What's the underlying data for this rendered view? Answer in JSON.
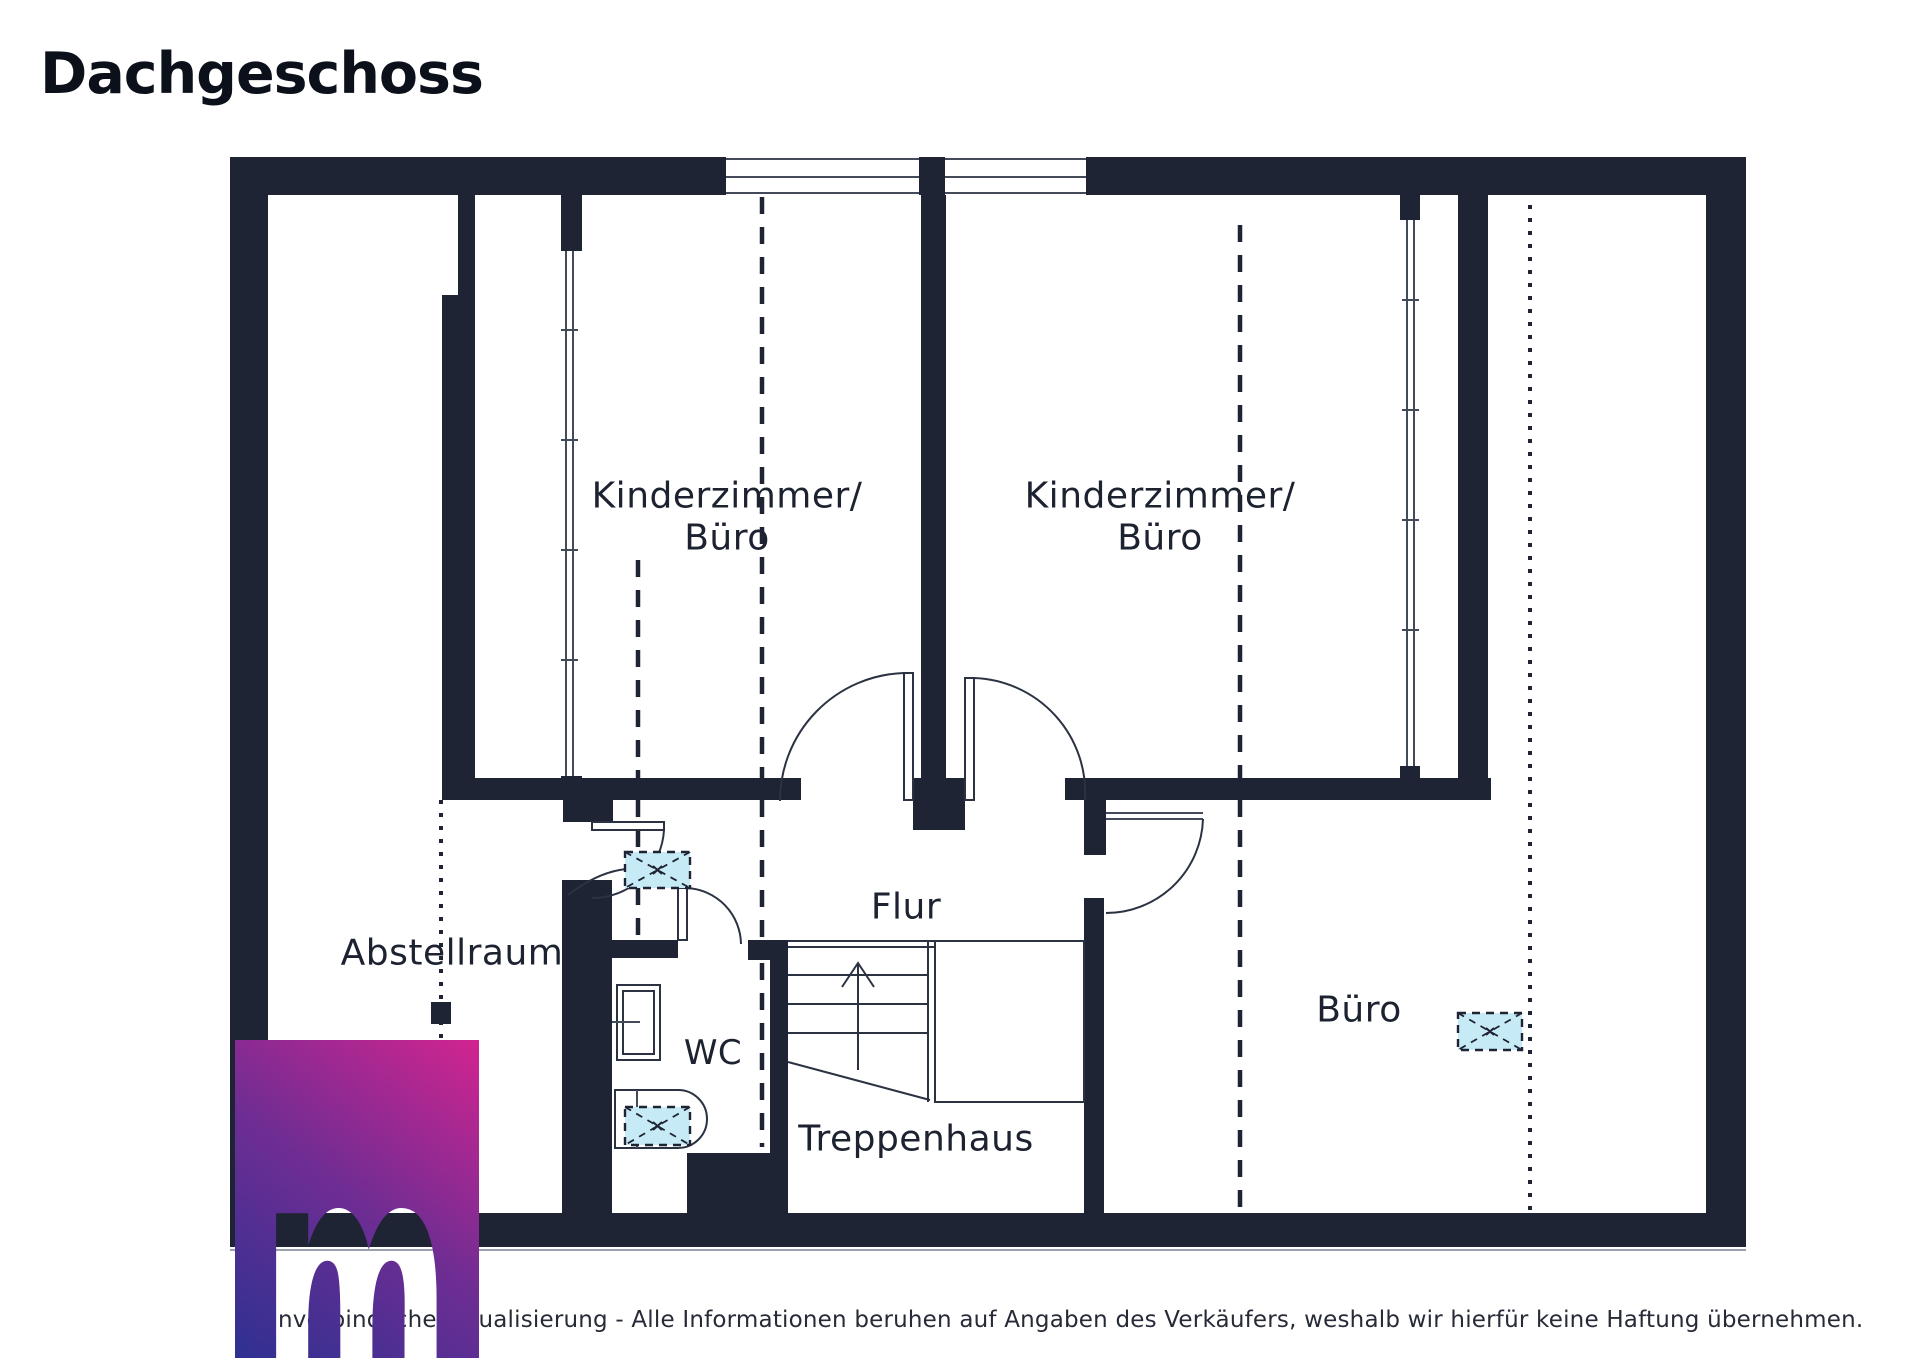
{
  "title": "Dachgeschoss",
  "rooms": {
    "k1": {
      "line1": "Kinderzimmer/",
      "line2": "Büro"
    },
    "k2": {
      "line1": "Kinderzimmer/",
      "line2": "Büro"
    },
    "flur": {
      "label": "Flur"
    },
    "abstellraum": {
      "label": "Abstellraum"
    },
    "wc": {
      "label": "WC"
    },
    "buero": {
      "label": "Büro"
    },
    "treppenhaus": {
      "label": "Treppenhaus"
    }
  },
  "footer": {
    "disclaimer": "Unverbindliche Visualisierung - Alle Informationen beruhen auf Angaben des Verkäufers, weshalb wir hierfür keine Haftung übernehmen."
  },
  "logo": {
    "letter": "m"
  },
  "symbols": {
    "skylight": "roof-window",
    "stairs_arrow": "up"
  },
  "colors": {
    "wall": "#1e2433",
    "label": "#1c2230",
    "skylight_fill": "#c7ebf6",
    "logo_blue": "#2e3192",
    "logo_purple": "#6f2d93",
    "logo_pink": "#d22490"
  }
}
